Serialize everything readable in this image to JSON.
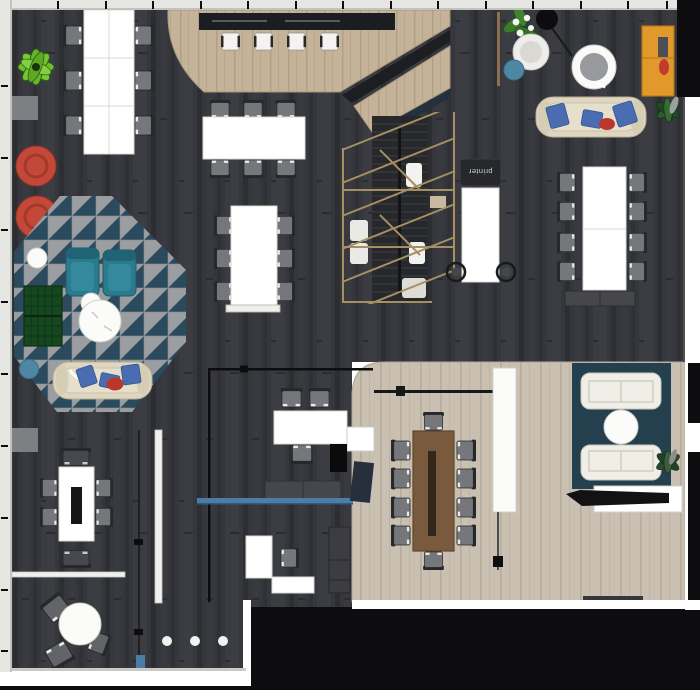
{
  "labels": {
    "printer": "printer"
  },
  "palette": {
    "wall": "#e6e6e3",
    "wallLine": "#c2c2bf",
    "ink": "#0d0d0f",
    "floor": "#35373c",
    "floorLight": "#42454b",
    "floorDark": "#2a2c30",
    "beige": "#c9c0b2",
    "beigeLine": "#b7ad9f",
    "tan": "#c4b299",
    "tanLine": "#b2a086",
    "white": "#ffffff",
    "paper": "#fbfbf9",
    "chair": "#75777b",
    "chairDark": "#46484d",
    "chairInk": "#27282c",
    "cream": "#ded6c0",
    "creamLine": "#b7ae96",
    "pillowBlue": "#4a6db2",
    "pillowRed": "#bb372c",
    "redPouf": "#c2493a",
    "redPoufDark": "#9c3325",
    "tealChair": "#2b7a8d",
    "tealPouf": "#4e87a2",
    "navyRug": "#24404f",
    "carpetGray": "#9b9ea1",
    "carpetNavy": "#2b4a5e",
    "greenBright": "#6fbe2e",
    "greenDark": "#2e6414",
    "greenSofa": "#17471f",
    "wood": "#7a5a3d",
    "woodDark": "#33271c",
    "rail": "#a68f63",
    "orange": "#e2992b",
    "glassTeal": "#4b7ea6",
    "matGray": "#7d7f82"
  },
  "inventory": {
    "areas": [
      "open-plan-office",
      "conference-platform",
      "staircase",
      "meeting-room",
      "lounge-rug",
      "triangle-pattern-carpet",
      "exterior-void"
    ],
    "furniture": [
      "workbench-table-6",
      "bar-counter",
      "white-bar-stools",
      "meeting-table-6",
      "standing-table-6",
      "team-table-8",
      "printer-station",
      "printer-counter",
      "printer-stools",
      "storage-cabinet",
      "wood-conference-table",
      "conference-chairs",
      "white-pillar",
      "white-sideboard",
      "media-console",
      "lounge-sofas",
      "lounge-coffee-table",
      "cream-sofas",
      "teal-armchairs",
      "green-plaid-sofa",
      "red-ottomans",
      "teal-ottomans",
      "white-ottoman",
      "round-coffee-tables",
      "round-table",
      "focus-table",
      "l-shaped-desk",
      "double-desk",
      "bench-blocks",
      "bucket-chair",
      "arc-lamp",
      "round-side-table",
      "coat-rack",
      "orange-cabinet",
      "plants",
      "glass-partition",
      "doormat"
    ]
  }
}
